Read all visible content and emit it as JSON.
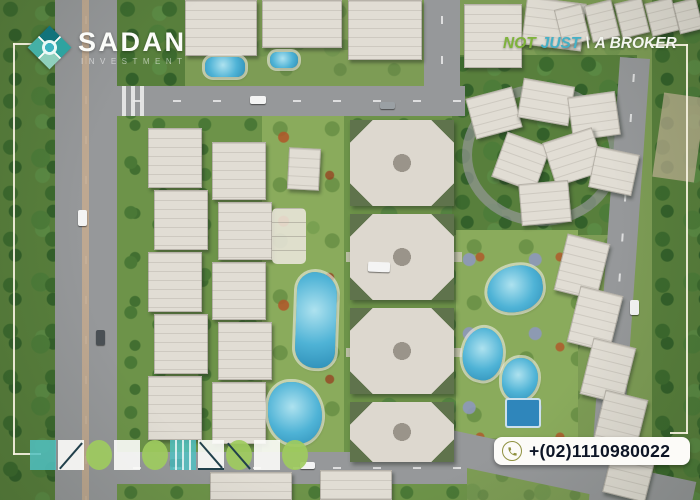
{
  "header": {
    "logo": {
      "icon": "sadan-diamond-logo",
      "name": "SADAN",
      "subtitle": "INVESTMENT"
    },
    "tagline": {
      "part1": "NOT",
      "part2": "JUST",
      "separator": "\\",
      "part3": "A BROKER"
    }
  },
  "footer": {
    "phone": {
      "icon": "phone-icon",
      "number": "+(02)1110980022"
    },
    "decor_shapes": [
      {
        "shape": "square",
        "color": "teal"
      },
      {
        "shape": "square",
        "color": "white",
        "line": "diag-up"
      },
      {
        "shape": "circle",
        "color": "green"
      },
      {
        "shape": "square",
        "color": "white"
      },
      {
        "shape": "circle",
        "color": "green"
      },
      {
        "shape": "square",
        "color": "teal",
        "line": "stripes"
      },
      {
        "shape": "square",
        "color": "white",
        "line": "tri"
      },
      {
        "shape": "circle",
        "color": "green",
        "line": "diag-down"
      },
      {
        "shape": "square",
        "color": "white"
      },
      {
        "shape": "circle",
        "color": "green"
      }
    ]
  },
  "palette": {
    "teal": "#50bfc1",
    "green": "#9ecb5e",
    "navy_line": "#21404b",
    "tagline_green": "#7fb33c",
    "tagline_teal": "#45b0c6",
    "olive_icon": "#8f9140",
    "phone_text": "#0d1526",
    "frame_line": "#f8f3e2"
  }
}
